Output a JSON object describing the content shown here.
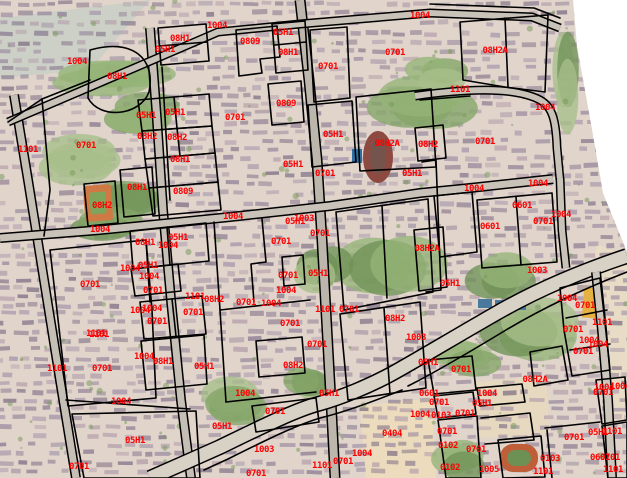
{
  "map": {
    "label_color": "#ff0000",
    "boundary_color": "#000000",
    "distinct_codes": [
      "0102",
      "0103",
      "0404",
      "05H1",
      "0601",
      "0701",
      "0809",
      "08H1",
      "08H2",
      "08H2A",
      "1003",
      "1004",
      "1005",
      "1101"
    ],
    "labels": [
      {
        "x": 77,
        "y": 61,
        "text": "1004"
      },
      {
        "x": 117,
        "y": 76,
        "text": "08H1"
      },
      {
        "x": 180,
        "y": 38,
        "text": "08H1"
      },
      {
        "x": 165,
        "y": 49,
        "text": "05H1"
      },
      {
        "x": 146,
        "y": 115,
        "text": "05H1"
      },
      {
        "x": 175,
        "y": 112,
        "text": "05H1"
      },
      {
        "x": 147,
        "y": 136,
        "text": "08H2"
      },
      {
        "x": 177,
        "y": 137,
        "text": "08H2"
      },
      {
        "x": 28,
        "y": 149,
        "text": "1101"
      },
      {
        "x": 86,
        "y": 145,
        "text": "0701"
      },
      {
        "x": 180,
        "y": 159,
        "text": "08H1"
      },
      {
        "x": 137,
        "y": 187,
        "text": "08H1"
      },
      {
        "x": 183,
        "y": 191,
        "text": "0809"
      },
      {
        "x": 102,
        "y": 205,
        "text": "08H2"
      },
      {
        "x": 100,
        "y": 229,
        "text": "1004"
      },
      {
        "x": 145,
        "y": 242,
        "text": "08H1"
      },
      {
        "x": 178,
        "y": 237,
        "text": "05H1"
      },
      {
        "x": 168,
        "y": 245,
        "text": "1004"
      },
      {
        "x": 130,
        "y": 268,
        "text": "1004"
      },
      {
        "x": 148,
        "y": 265,
        "text": "05H1"
      },
      {
        "x": 149,
        "y": 276,
        "text": "1004"
      },
      {
        "x": 217,
        "y": 25,
        "text": "1004"
      },
      {
        "x": 250,
        "y": 41,
        "text": "0809"
      },
      {
        "x": 283,
        "y": 32,
        "text": "05H1"
      },
      {
        "x": 288,
        "y": 52,
        "text": "08H1"
      },
      {
        "x": 286,
        "y": 103,
        "text": "0809"
      },
      {
        "x": 235,
        "y": 117,
        "text": "0701"
      },
      {
        "x": 420,
        "y": 15,
        "text": "1004"
      },
      {
        "x": 395,
        "y": 52,
        "text": "0701"
      },
      {
        "x": 328,
        "y": 66,
        "text": "0701"
      },
      {
        "x": 460,
        "y": 89,
        "text": "1101"
      },
      {
        "x": 495,
        "y": 50,
        "text": "08H2A"
      },
      {
        "x": 545,
        "y": 107,
        "text": "1004"
      },
      {
        "x": 333,
        "y": 134,
        "text": "05H1"
      },
      {
        "x": 293,
        "y": 164,
        "text": "05H1"
      },
      {
        "x": 325,
        "y": 173,
        "text": "0701"
      },
      {
        "x": 387,
        "y": 143,
        "text": "08H2A"
      },
      {
        "x": 412,
        "y": 173,
        "text": "05H1"
      },
      {
        "x": 233,
        "y": 216,
        "text": "1004"
      },
      {
        "x": 295,
        "y": 221,
        "text": "05H1"
      },
      {
        "x": 304,
        "y": 218,
        "text": "1003"
      },
      {
        "x": 320,
        "y": 233,
        "text": "0701"
      },
      {
        "x": 281,
        "y": 241,
        "text": "0701"
      },
      {
        "x": 288,
        "y": 275,
        "text": "0701"
      },
      {
        "x": 318,
        "y": 273,
        "text": "05H1"
      },
      {
        "x": 286,
        "y": 290,
        "text": "1004"
      },
      {
        "x": 428,
        "y": 144,
        "text": "08H2"
      },
      {
        "x": 485,
        "y": 141,
        "text": "0701"
      },
      {
        "x": 474,
        "y": 188,
        "text": "1004"
      },
      {
        "x": 538,
        "y": 183,
        "text": "1004"
      },
      {
        "x": 522,
        "y": 205,
        "text": "0601"
      },
      {
        "x": 561,
        "y": 214,
        "text": "1004"
      },
      {
        "x": 543,
        "y": 221,
        "text": "0701"
      },
      {
        "x": 490,
        "y": 226,
        "text": "0601"
      },
      {
        "x": 427,
        "y": 248,
        "text": "08H2A"
      },
      {
        "x": 450,
        "y": 283,
        "text": "05H1"
      },
      {
        "x": 537,
        "y": 270,
        "text": "1003"
      },
      {
        "x": 90,
        "y": 284,
        "text": "0701"
      },
      {
        "x": 153,
        "y": 290,
        "text": "0701"
      },
      {
        "x": 195,
        "y": 296,
        "text": "1101"
      },
      {
        "x": 140,
        "y": 310,
        "text": "1004"
      },
      {
        "x": 152,
        "y": 308,
        "text": "1004"
      },
      {
        "x": 193,
        "y": 312,
        "text": "0701"
      },
      {
        "x": 157,
        "y": 321,
        "text": "0701"
      },
      {
        "x": 96,
        "y": 333,
        "text": "1101"
      },
      {
        "x": 99,
        "y": 334,
        "text": "1101"
      },
      {
        "x": 144,
        "y": 356,
        "text": "1004"
      },
      {
        "x": 163,
        "y": 361,
        "text": "08H1"
      },
      {
        "x": 57,
        "y": 368,
        "text": "1101"
      },
      {
        "x": 102,
        "y": 368,
        "text": "0701"
      },
      {
        "x": 204,
        "y": 366,
        "text": "05H1"
      },
      {
        "x": 121,
        "y": 401,
        "text": "1004"
      },
      {
        "x": 135,
        "y": 440,
        "text": "05H1"
      },
      {
        "x": 79,
        "y": 466,
        "text": "0701"
      },
      {
        "x": 222,
        "y": 426,
        "text": "05H1"
      },
      {
        "x": 214,
        "y": 299,
        "text": "08H2"
      },
      {
        "x": 246,
        "y": 302,
        "text": "0701"
      },
      {
        "x": 271,
        "y": 303,
        "text": "1004"
      },
      {
        "x": 290,
        "y": 323,
        "text": "0701"
      },
      {
        "x": 325,
        "y": 309,
        "text": "1101"
      },
      {
        "x": 349,
        "y": 309,
        "text": "0701"
      },
      {
        "x": 395,
        "y": 318,
        "text": "08H2"
      },
      {
        "x": 317,
        "y": 344,
        "text": "0701"
      },
      {
        "x": 416,
        "y": 337,
        "text": "1003"
      },
      {
        "x": 293,
        "y": 365,
        "text": "08H2"
      },
      {
        "x": 245,
        "y": 393,
        "text": "1004"
      },
      {
        "x": 329,
        "y": 393,
        "text": "05H1"
      },
      {
        "x": 275,
        "y": 411,
        "text": "0701"
      },
      {
        "x": 264,
        "y": 449,
        "text": "1003"
      },
      {
        "x": 392,
        "y": 433,
        "text": "0404"
      },
      {
        "x": 362,
        "y": 453,
        "text": "1004"
      },
      {
        "x": 343,
        "y": 461,
        "text": "0701"
      },
      {
        "x": 322,
        "y": 465,
        "text": "1101"
      },
      {
        "x": 256,
        "y": 473,
        "text": "0701"
      },
      {
        "x": 567,
        "y": 298,
        "text": "1004"
      },
      {
        "x": 585,
        "y": 305,
        "text": "0701"
      },
      {
        "x": 602,
        "y": 322,
        "text": "1101"
      },
      {
        "x": 573,
        "y": 329,
        "text": "0701"
      },
      {
        "x": 589,
        "y": 340,
        "text": "1004"
      },
      {
        "x": 598,
        "y": 344,
        "text": "1004"
      },
      {
        "x": 583,
        "y": 351,
        "text": "0701"
      },
      {
        "x": 428,
        "y": 362,
        "text": "05H1"
      },
      {
        "x": 461,
        "y": 369,
        "text": "0701"
      },
      {
        "x": 535,
        "y": 379,
        "text": "08H2A"
      },
      {
        "x": 620,
        "y": 386,
        "text": "1004"
      },
      {
        "x": 429,
        "y": 393,
        "text": "0601"
      },
      {
        "x": 439,
        "y": 402,
        "text": "0701"
      },
      {
        "x": 487,
        "y": 393,
        "text": "1004"
      },
      {
        "x": 482,
        "y": 403,
        "text": "05H1"
      },
      {
        "x": 420,
        "y": 414,
        "text": "1004"
      },
      {
        "x": 441,
        "y": 415,
        "text": "0103"
      },
      {
        "x": 465,
        "y": 413,
        "text": "0701"
      },
      {
        "x": 447,
        "y": 431,
        "text": "0701"
      },
      {
        "x": 448,
        "y": 445,
        "text": "0102"
      },
      {
        "x": 476,
        "y": 449,
        "text": "0701"
      },
      {
        "x": 450,
        "y": 467,
        "text": "0102"
      },
      {
        "x": 489,
        "y": 469,
        "text": "1005"
      },
      {
        "x": 550,
        "y": 458,
        "text": "0103"
      },
      {
        "x": 574,
        "y": 437,
        "text": "0701"
      },
      {
        "x": 598,
        "y": 432,
        "text": "05H1"
      },
      {
        "x": 612,
        "y": 431,
        "text": "1101"
      },
      {
        "x": 604,
        "y": 387,
        "text": "1004"
      },
      {
        "x": 603,
        "y": 392,
        "text": "0701"
      },
      {
        "x": 600,
        "y": 457,
        "text": "0601"
      },
      {
        "x": 610,
        "y": 457,
        "text": "0701"
      },
      {
        "x": 613,
        "y": 469,
        "text": "1101"
      },
      {
        "x": 543,
        "y": 471,
        "text": "1101"
      }
    ]
  }
}
